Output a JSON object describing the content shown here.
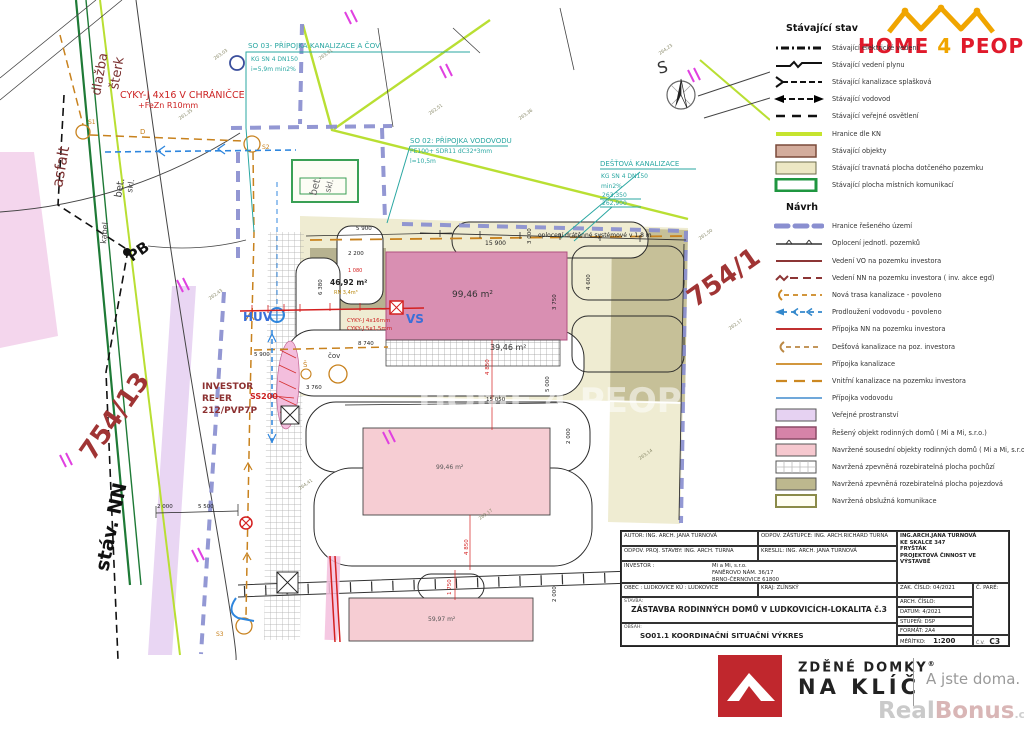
{
  "header_logo": {
    "home": "HOME",
    "four": "4",
    "people": "PEOPLE"
  },
  "colors": {
    "brand_red": "#e01a2b",
    "crown_orange": "#f0a500",
    "kn_green": "#c6e42e",
    "boundary_purple": "#8a8fd0",
    "main_pink": "#d683a8",
    "neighbor_pink": "#f6c8cf",
    "drive_khaki": "#bdb88e",
    "public_lavender": "#e6d2f2",
    "teal": "#2aa7a2",
    "red": "#d42020",
    "dark_red": "#8c3030",
    "orange": "#c8821e",
    "blue": "#2e86de",
    "logo_square_red": "#c0272d"
  },
  "legend": {
    "existing_title": "Stávající stav",
    "proposal_title": "Návrh",
    "existing_items": [
      {
        "label": "Stávající elektrické vedení",
        "type": "line-electric"
      },
      {
        "label": "Stávající vedení plynu",
        "type": "line-gas"
      },
      {
        "label": "Stávající kanalizace splašková",
        "type": "line-sewer"
      },
      {
        "label": "Stávající vodovod",
        "type": "line-water"
      },
      {
        "label": "Stávající veřejné osvětlení",
        "type": "line-lighting"
      },
      {
        "label": "Hranice dle KN",
        "type": "line-kn"
      },
      {
        "label": "Stávající objekty",
        "type": "swatch-existing-building"
      },
      {
        "label": "Stávající travnatá plocha dotčeného pozemku",
        "type": "swatch-grass"
      },
      {
        "label": "Stávající plocha místních komunikací",
        "type": "swatch-roads"
      }
    ],
    "proposal_items": [
      {
        "label": "Hranice řešeného území",
        "type": "line-boundary"
      },
      {
        "label": "Oplocení jednotl. pozemků",
        "type": "line-fence"
      },
      {
        "label": "Vedení VO na pozemku investora",
        "type": "line-vo"
      },
      {
        "label": "Vedení NN na pozemku investora ( inv. akce egd)",
        "type": "line-nn"
      },
      {
        "label": "Nová trasa kanalizace - povoleno",
        "type": "line-new-sewer"
      },
      {
        "label": "Prodloužení vodovodu - povoleno",
        "type": "line-water-ext"
      },
      {
        "label": "Přípojka NN na pozemku investora",
        "type": "line-nn-conn"
      },
      {
        "label": "Dešťová kanalizace na poz. investora",
        "type": "line-rain"
      },
      {
        "label": "Přípojka kanalizace",
        "type": "line-sewer-conn"
      },
      {
        "label": "Vnitřní kanalizace na pozemku investora",
        "type": "line-inner-sewer"
      },
      {
        "label": "Přípojka vodovodu",
        "type": "line-water-conn"
      },
      {
        "label": "Veřejné prostranství",
        "type": "swatch-public"
      },
      {
        "label": "Řešený objekt rodinných domů ( Mi a Mi, s.r.o.)",
        "type": "swatch-main-building"
      },
      {
        "label": "Navržené sousední objekty  rodinných domů ( Mi a Mi, s.r.o.)",
        "type": "swatch-neighbor-building"
      },
      {
        "label": "Navržená zpevněná rozebiratelná plocha pochůzí",
        "type": "swatch-walk"
      },
      {
        "label": "Navržená zpevněná rozebiratelná plocha pojezdová",
        "type": "swatch-drive"
      },
      {
        "label": "Navržená obslužná komunikace",
        "type": "swatch-service-road"
      }
    ]
  },
  "title_block": {
    "autor": "AUTOR: ING. ARCH. JANA TURNOVÁ",
    "odpov_zastupce": "ODPOV. ZÁSTUPCE: ING. ARCH.RICHARD TURNA",
    "odpov_proj": "ODPOV. PROJ. STAVBY: ING. ARCH. TURNA",
    "kreslil": "KRESLIL: ING. ARCH. JANA TURNOVÁ",
    "investor_label": "INVESTOR :",
    "investor_name": "Mi a Mi, s.r.o.",
    "investor_addr1": "FANĚROVO NÁM. 36/17",
    "investor_addr2": "BRNO-ČERNOVICE 61800",
    "obec": "OBEC : LUDKOVICE    KÚ : LUDKOVICE",
    "kraj": "KRAJ: ZLÍNSKÝ",
    "stavba_label": "STAVBA:",
    "stavba_title": "ZÁSTAVBA RODINNÝCH DOMŮ V LUDKOVICÍCH-LOKALITA č.3",
    "obsah_label": "OBSAH:",
    "obsah_title": "SO01.1 KOORDINAČNÍ SITUAČNÍ VÝKRES",
    "firm1": "ING.ARCH.JANA TURNOVÁ",
    "firm2": "KE SKALCE 347",
    "firm3": "FRYŠTÁK",
    "firm4": "PROJEKTOVÁ ČINNOST VE VÝSTAVBĚ",
    "zak_cislo": "ZAK. ČÍSLO:  04/2021",
    "arch_cislo": "ARCH. ČÍSLO:",
    "datum": "DATUM: 4/2021",
    "stupen": "STUPEŇ: DSP",
    "format": "FORMÁT: 2A4",
    "meritko_label": "MĚŘÍTKO:",
    "meritko_value": "1:200",
    "c_pare": "Č. PARÉ:",
    "cv_label": "Č.V.",
    "cv_value": "C3"
  },
  "footer_logo": {
    "line1": "ZDĚNÉ DOMKY",
    "reg": "®",
    "line2": "NA KLÍČ",
    "tagline": "A jste doma.",
    "watermark_a": "Real",
    "watermark_b": "Bonus",
    "watermark_tld": ".cz"
  },
  "drawing": {
    "watermark": "HOME 4 PEOPLE",
    "parcel_754_1": "754/1",
    "parcel_754_13": "754/13",
    "stav_nn": "stáv. NN",
    "asfalt": "asfalt",
    "dlazba": "dlažba",
    "sterk": "šterk",
    "bet": "bet.",
    "skl": "skl.",
    "kabel": "kabel",
    "pb": "PB",
    "north": "S",
    "so03_t": "SO 03- PŘÍPOJKA KANALIZACE A ČOV",
    "so03_l1": "KG SN 4 DN150",
    "so03_l2": "i=5,9m min2%",
    "so02_t": "SO 02: PŘÍPOJKA VODOVODU",
    "so02_l1": "PE100+ SDR11 dC32*3mm",
    "so02_l2": "l=10,5m",
    "rain_t": "DEŠŤOVÁ KANALIZACE",
    "rain_l1": "KG SN 4 DN150",
    "rain_l2": "min2%",
    "rain_e1": "263,350",
    "rain_e2": "262,900",
    "cyky1": "CYKY-J 4x16 V CHRÁNIČCE",
    "cyky2": "+FeZn R10mm",
    "cyky3": "CYKY-J 4x16mm",
    "cyky4": "CYKY-J 5x1,5mm",
    "fence": "oplocení drátěnné systémové v 1,8 m",
    "area_main": "99,46 m²",
    "area_garage": "46,92 m²",
    "area_paved": "39,46 m²",
    "area_neighbor": "99,46 m²",
    "area_small": "59,97 m²",
    "rn": "RN 3,4m³",
    "investor_l1": "INVESTOR",
    "investor_l2": "RE-ER",
    "investor_l3": "212/PVP7P",
    "ss200": "SS200",
    "huv": "HUV",
    "dvs_vs": "VS",
    "cov": "čov",
    "sh": "Š",
    "s1": "S1",
    "s2": "S2",
    "s3": "S3",
    "dmark": "D",
    "dims": {
      "a": "5 900",
      "b": "15 900",
      "c": "2 200",
      "d": "3 000",
      "e": "8 740",
      "f": "3 760",
      "g": "15 050",
      "h": "5 900",
      "i": "2 000",
      "j": "5 500",
      "k": "5 000",
      "l": "14 200",
      "m": "4 600",
      "n": "3 750",
      "o": "6 380",
      "p": "4 850",
      "q": "1 750",
      "r": "2 000",
      "s": "1 080",
      "t": "4 850",
      "u": "2 000"
    },
    "spots": [
      "263,03",
      "261,35",
      "263,91",
      "262,51",
      "263,36",
      "264,23",
      "261,50",
      "262,17",
      "263,14",
      "264,41",
      "262,43",
      "263,17"
    ]
  }
}
